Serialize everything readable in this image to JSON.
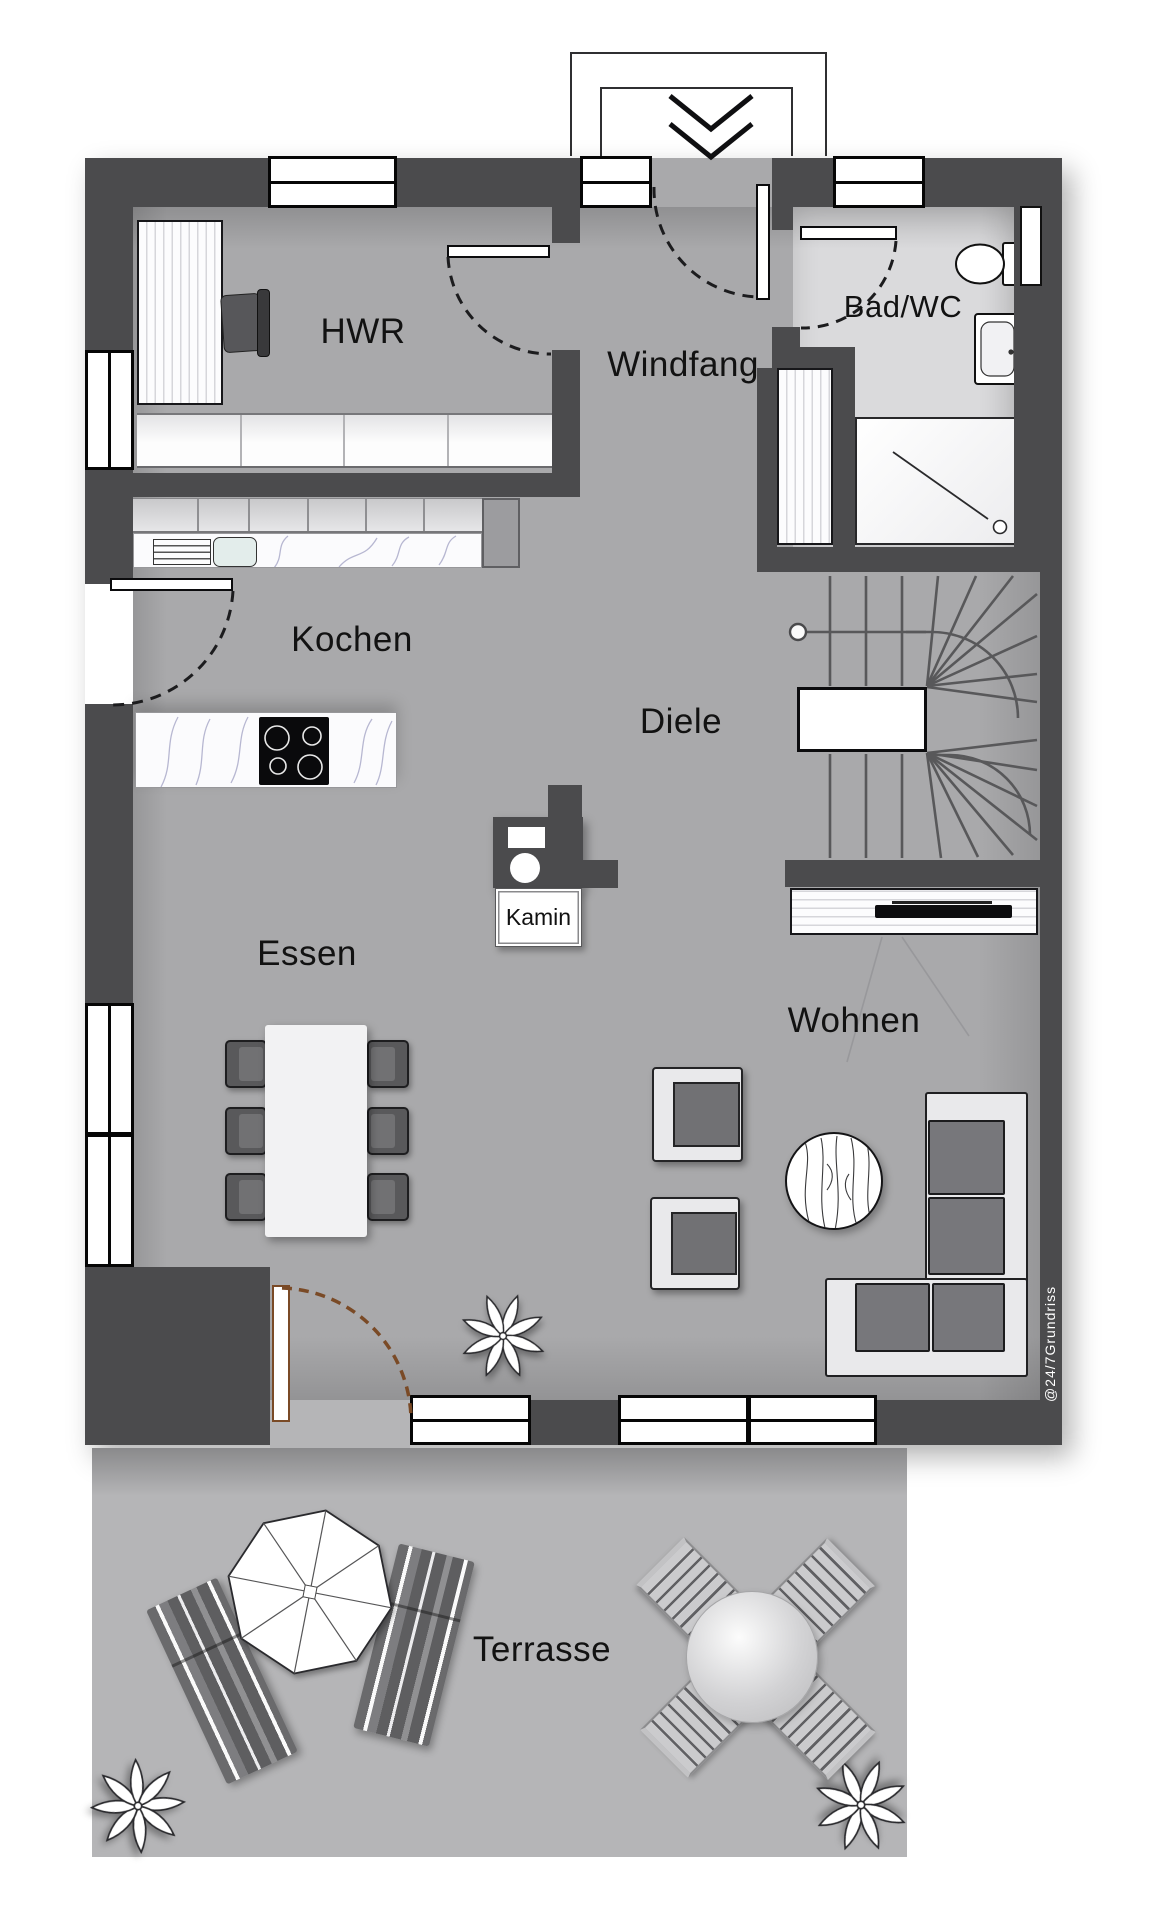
{
  "labels": {
    "hwr": "HWR",
    "windfang": "Windfang",
    "bad_wc": "Bad/WC",
    "kochen": "Kochen",
    "diele": "Diele",
    "essen": "Essen",
    "wohnen": "Wohnen",
    "kamin": "Kamin",
    "terrasse": "Terrasse"
  },
  "watermark": "@24/7Grundriss",
  "colors": {
    "wall": "#4b4b4d",
    "floor": "#a9a9ab",
    "bad_floor": "#dadadc",
    "terrace_floor": "#b5b5b7",
    "background": "#ffffff",
    "terrace_door_frame": "#7a4a26",
    "furniture_dark": "#5a5a5c",
    "furniture_light": "#ececee",
    "countertop_vein": "#9393bb"
  }
}
